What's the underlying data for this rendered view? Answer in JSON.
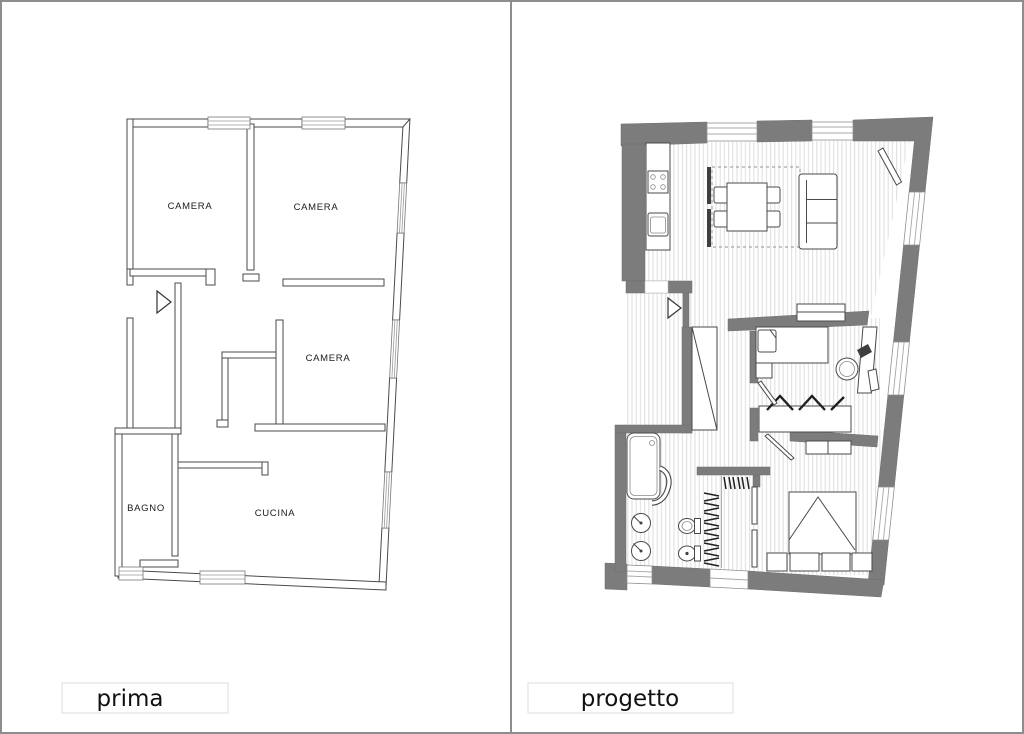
{
  "figure": {
    "type": "floor-plan-comparison",
    "description": "Before/after apartment floor plans side by side"
  },
  "before": {
    "caption": "prima",
    "rooms": {
      "camera1": "CAMERA",
      "camera2": "CAMERA",
      "camera3": "CAMERA",
      "bagno": "BAGNO",
      "cucina": "CUCINA"
    }
  },
  "after": {
    "caption": "progetto"
  },
  "colors": {
    "wall_grey": "#7c7c7c",
    "line": "#4a4a4a",
    "floor_hatch": "#e0e0e0",
    "frame": "#8d8d8d",
    "caption_border": "#dcdcdc",
    "text": "#1b1b1b",
    "background": "#ffffff"
  }
}
